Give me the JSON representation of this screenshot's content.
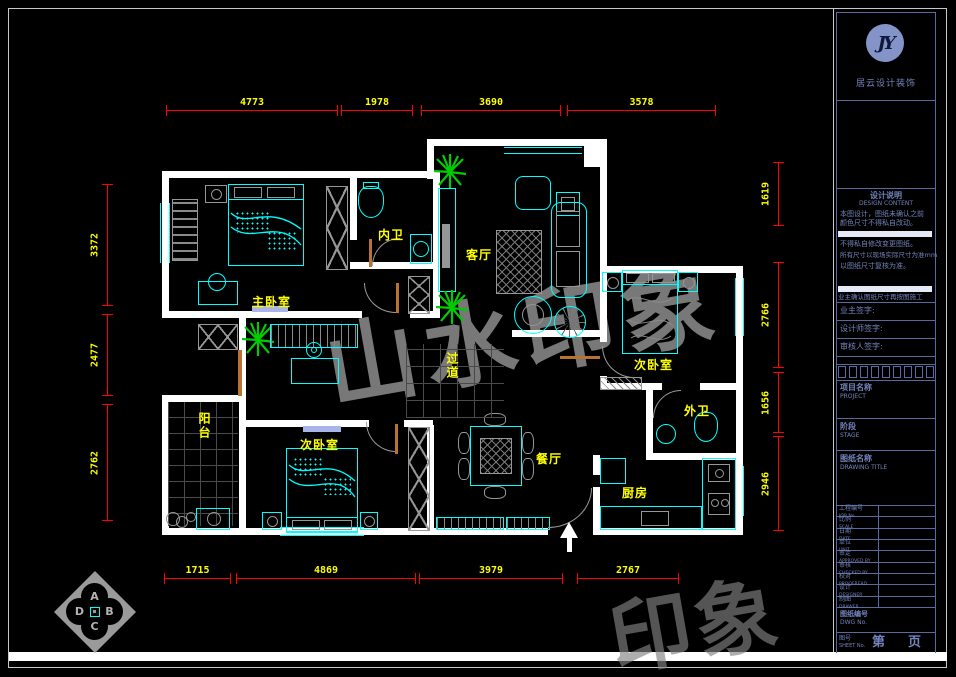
{
  "logo": {
    "monogram": "JY",
    "company": "居云设计装饰"
  },
  "title_block": {
    "notes": {
      "title_cn": "设计说明",
      "title_en": "DESIGN CONTENT",
      "line1": "本图设计，图纸未确认之前",
      "line2": "颜色尺寸不得私自改动。",
      "line3": "不得私自修改变更图纸。",
      "line4": "所有尺寸以现场实际尺寸为准mm",
      "line5": "以图纸尺寸复核为准。",
      "confirm": "业主确认图纸尺寸再按图施工"
    },
    "sign1": "业主签字:",
    "sign2": "设计师签字:",
    "sign3": "审核人签字:",
    "project_cn": "项目名称",
    "project_en": "PROJECT",
    "stage_cn": "阶段",
    "stage_en": "STAGE",
    "dtitle_cn": "图纸名称",
    "dtitle_en": "DRAWING TITLE",
    "rows": [
      {
        "cn": "工程编号",
        "en": "JOB No."
      },
      {
        "cn": "比例",
        "en": "SCALE"
      },
      {
        "cn": "日期",
        "en": "DATE"
      },
      {
        "cn": "单位",
        "en": "UNIT"
      },
      {
        "cn": "审定",
        "en": "APPROVED BY"
      },
      {
        "cn": "审核",
        "en": "CHECKED BY"
      },
      {
        "cn": "校对",
        "en": "PROOFREAD"
      },
      {
        "cn": "设计",
        "en": "DESIGNER"
      },
      {
        "cn": "制图",
        "en": "DRAWER"
      }
    ],
    "dwg_cn": "图纸编号",
    "dwg_en": "DWG No.",
    "sheet_cn": "图号",
    "sheet_en": "SHEET No.",
    "sheet_page_1": "第",
    "sheet_page_2": "页"
  },
  "rooms": {
    "master": "主卧室",
    "inner_bath": "内卫",
    "living": "客厅",
    "bed_right": "次卧室",
    "corridor": "过道",
    "balcony": "阳台",
    "bed_bottom": "次卧室",
    "dining": "餐厅",
    "outer_bath": "外卫",
    "kitchen": "厨房"
  },
  "dims": {
    "top": [
      "4773",
      "1978",
      "3690",
      "3578"
    ],
    "bottom": [
      "1715",
      "4869",
      "3979",
      "2767"
    ],
    "left": [
      "3372",
      "2477",
      "2762"
    ],
    "right": [
      "1619",
      "2766",
      "1656",
      "2946"
    ]
  },
  "compass": {
    "a": "A",
    "b": "B",
    "c": "C",
    "d": "D"
  },
  "watermark": {
    "main": "山水印象",
    "partial": "印象"
  },
  "colors": {
    "wall": "#ffffff",
    "furniture": "#00ffff",
    "dimension": "#ff0000",
    "dim_text": "#ffff00",
    "room_label": "#ffff00",
    "plant": "#00cc00",
    "door": "#b87333",
    "titleblock": "#5a6aa0",
    "watermark": "#969696"
  }
}
